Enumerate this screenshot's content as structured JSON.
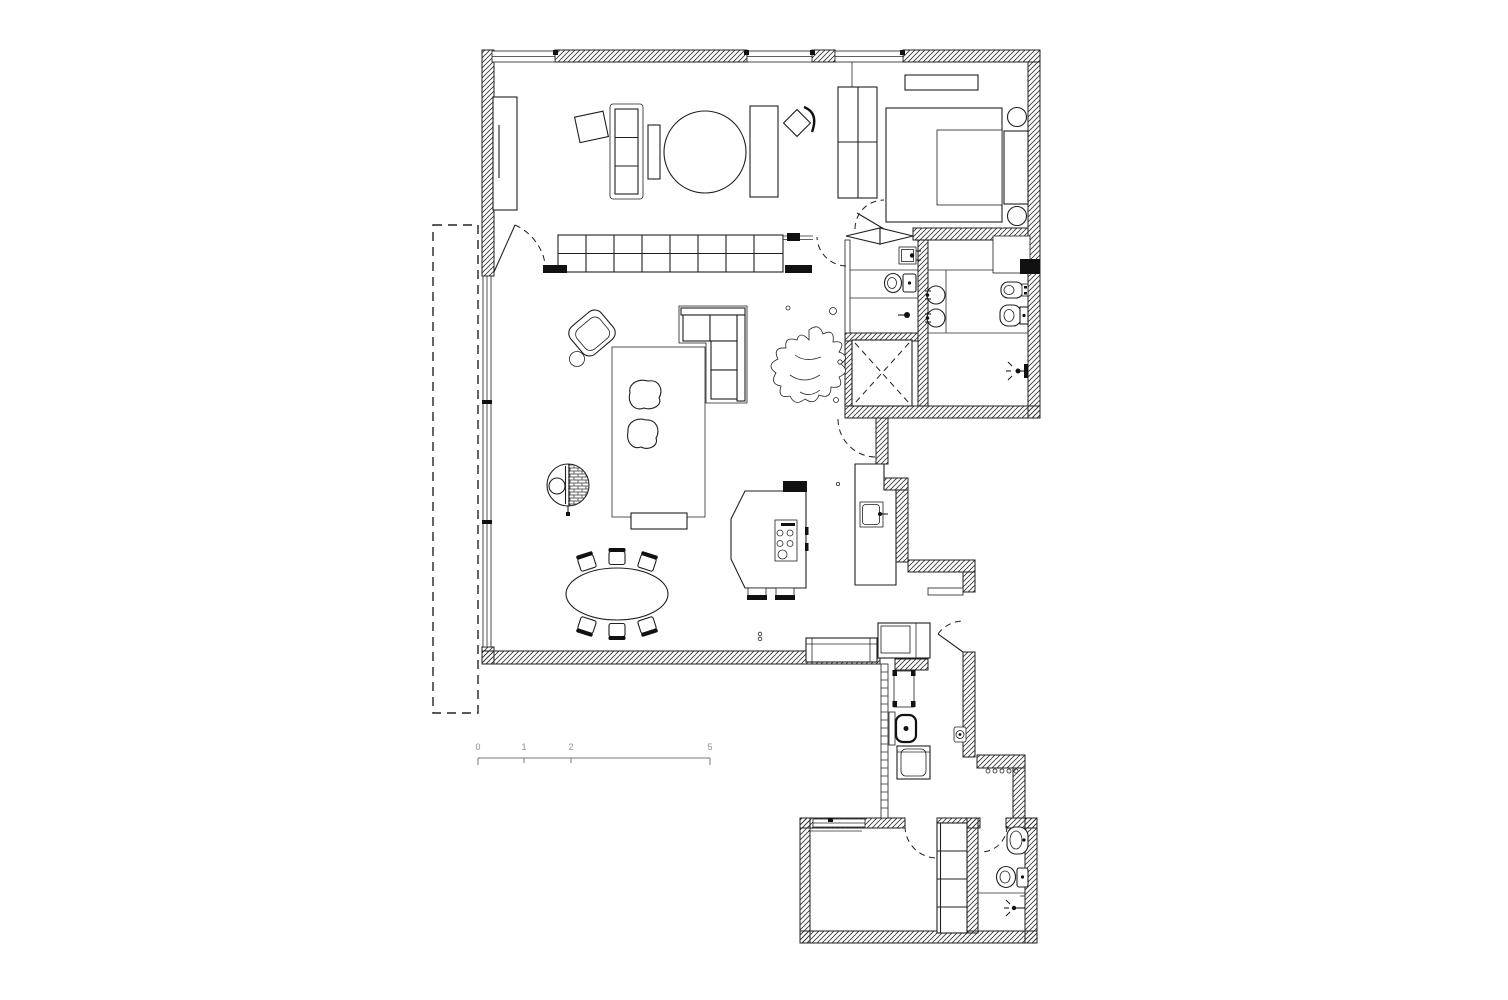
{
  "drawing": {
    "type": "apartment-floor-plan",
    "style": "black-and-white architectural line drawing, diagonal hatched walls on white background"
  },
  "colors": {
    "background": "#ffffff",
    "line": "#1f1f1f",
    "wall_hatch": "#3a3a3a",
    "fixture_black": "#111111",
    "scale_text": "#8f8f8f"
  },
  "scale_bar": {
    "labels": [
      "0",
      "1",
      "2",
      "5"
    ]
  },
  "symbols": [
    "hatched-exterior-walls",
    "window-strips",
    "balcony-dashed-outline",
    "glazed-window-wall",
    "study-sofa",
    "study-round-table",
    "study-benches",
    "study-chair",
    "tv-cabinet",
    "shelving-room-divider",
    "armchair-with-side-table",
    "rug-with-poufs",
    "corner-sofa",
    "floor-lamp-round-table",
    "plant",
    "oval-dining-table-six-chairs",
    "kitchen-island-with-cooktop",
    "kitchen-counter-with-sink",
    "wardrobe",
    "double-bed-with-side-tables",
    "headboard",
    "shelf",
    "wc-toilet",
    "wall-basins",
    "bidet",
    "shower-with-dashed-cross",
    "shower-head",
    "entry-bench",
    "entry-cabinet",
    "entry-door",
    "laundry-stool",
    "laundry-wc",
    "washing-machine",
    "bottom-room",
    "closet-column",
    "bathroom-sink",
    "bathroom-toilet",
    "door-swing-arcs"
  ]
}
